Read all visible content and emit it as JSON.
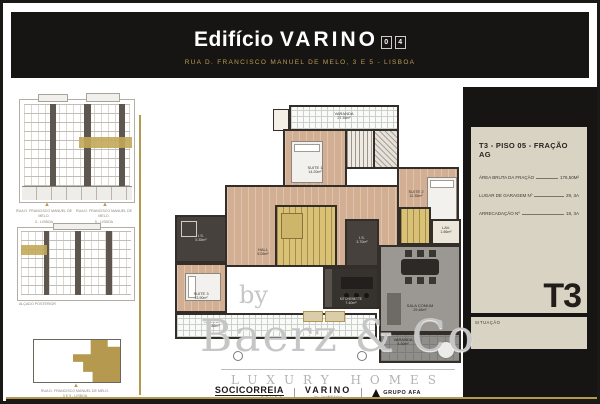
{
  "header": {
    "title_prefix": "Edifício",
    "title_main": "VARINO",
    "badge": [
      "0",
      "4"
    ],
    "subtitle": "RUA D. FRANCISCO MANUEL DE MELO, 3 E 5 - LISBOA"
  },
  "left_column": {
    "front_elevation": {
      "marker": "▲",
      "captions": [
        {
          "line1": "RUA D. FRANCISCO MANUEL DE MELO.",
          "line2": "3 - LISBOA"
        },
        {
          "line1": "RUA D. FRANCISCO MANUEL DE MELO.",
          "line2": "5 - LISBOA"
        }
      ]
    },
    "rear_elevation": {
      "caption": "ALÇADO POSTERIOR"
    },
    "site_plan": {
      "marker": "▲",
      "caption_line1": "RUA D. FRANCISCO MANUEL DE MELO.",
      "caption_line2": "3 E 5 - LISBOA"
    }
  },
  "floor_plan": {
    "rooms": {
      "varanda_top": {
        "label": "VARANDA",
        "area": "27.35m²"
      },
      "suite1": {
        "label": "SUITE 1",
        "area": "14.20m²"
      },
      "suite2": {
        "label": "SUITE 2",
        "area": "12.35m²"
      },
      "suite3": {
        "label": "SUITE 3",
        "area": "13.90m²"
      },
      "is_left": {
        "label": "I.S.",
        "area": "5.35m²"
      },
      "is_center": {
        "label": "I.S.",
        "area": "3.70m²"
      },
      "hall": {
        "label": "HALL",
        "area": "5.05m²"
      },
      "lav": {
        "label": "LAV.",
        "area": "1.86m²"
      },
      "kitchenette": {
        "label": "KITCHENETTE",
        "area": "7.40m²"
      },
      "sala_comum": {
        "label": "SALA COMUM",
        "area": "29.48m²"
      },
      "varanda_bottom": {
        "label": "VARANDA",
        "area": "10.86m²"
      },
      "varanda_right": {
        "label": "VARANDA",
        "area": "4.30m²"
      }
    }
  },
  "sidebar": {
    "title": "T3 - PISO 05 - FRAÇÃO AG",
    "specs": [
      {
        "label": "ÁREA BRUTA DA FRAÇÃO",
        "value": "176,50M²"
      },
      {
        "label": "LUGAR DE GARAGEM Nº",
        "value": "29, 3A"
      },
      {
        "label": "ARRECADAÇÃO Nº",
        "value": "18, 3A"
      }
    ],
    "type_label": "T3",
    "situation_label": "SITUAÇÃO"
  },
  "watermark": {
    "by": "by",
    "name": "Baerz & Co",
    "tagline": "LUXURY HOMES"
  },
  "footer": {
    "socicorreia": {
      "name": "SOCICORREIA",
      "sub": "GRUPO"
    },
    "varino": {
      "name": "VARINO",
      "sub": "inv. imobiliários"
    },
    "afa": {
      "name": "GRUPO AFA"
    }
  },
  "colors": {
    "gold_accent": "#b5994e",
    "header_black": "#171513",
    "card_beige": "#d9d3c3",
    "wood_floor": "#d2ae93",
    "wall_dark": "#332e2a",
    "stair_core_gold": "#d9c175"
  }
}
